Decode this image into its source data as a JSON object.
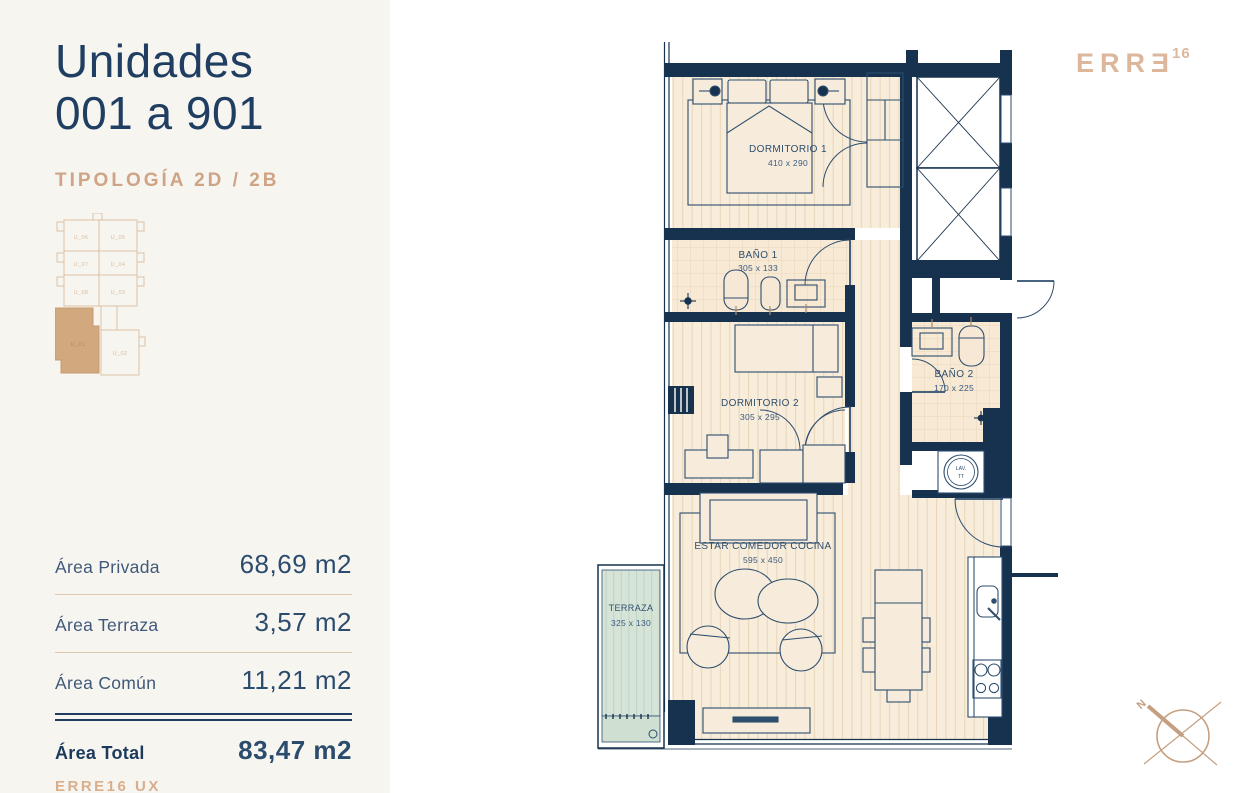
{
  "panel": {
    "title_line1": "Unidades",
    "title_line2": "001 a 901",
    "typology": "TIPOLOGÍA 2D / 2B",
    "areas": [
      {
        "label": "Área Privada",
        "value": "68,69 m2"
      },
      {
        "label": "Área Terraza",
        "value": "3,57 m2"
      },
      {
        "label": "Área Común",
        "value": "11,21 m2"
      }
    ],
    "total": {
      "label": "Área Total",
      "value": "83,47 m2"
    },
    "footer": "ERRE16 UX"
  },
  "logo": {
    "brand": "ERRƎ",
    "sup": "16"
  },
  "keyplan": {
    "units": [
      "U_06",
      "U_05",
      "U_07",
      "U_04",
      "U_08",
      "U_03",
      "U_01",
      "U_02"
    ],
    "highlighted_unit": "U_01"
  },
  "plan": {
    "rooms": [
      {
        "name": "DORMITORIO 1",
        "dims": "410 x 290"
      },
      {
        "name": "BAÑO 1",
        "dims": "305 x 133"
      },
      {
        "name": "DORMITORIO 2",
        "dims": "305 x 295"
      },
      {
        "name": "BAÑO 2",
        "dims": "170 x 225"
      },
      {
        "name": "ESTAR COMEDOR COCINA",
        "dims": "595 x 450"
      },
      {
        "name": "TERRAZA",
        "dims": "325 x 130"
      }
    ],
    "laundry": {
      "line1": "LAV.",
      "line2": "TT"
    }
  },
  "compass": {
    "north_label": "N"
  },
  "colors": {
    "wall_navy": "#16324e",
    "line_navy": "#2e4e6e",
    "title_navy": "#1f3e61",
    "accent_tan": "#cfa385",
    "logo_tan": "#dcb79c",
    "keyplan_fill": "#d2a87e",
    "floor_cream": "#f8edda",
    "terrace_green": "#d6e4d8",
    "panel_bg": "#f7f5f0"
  }
}
